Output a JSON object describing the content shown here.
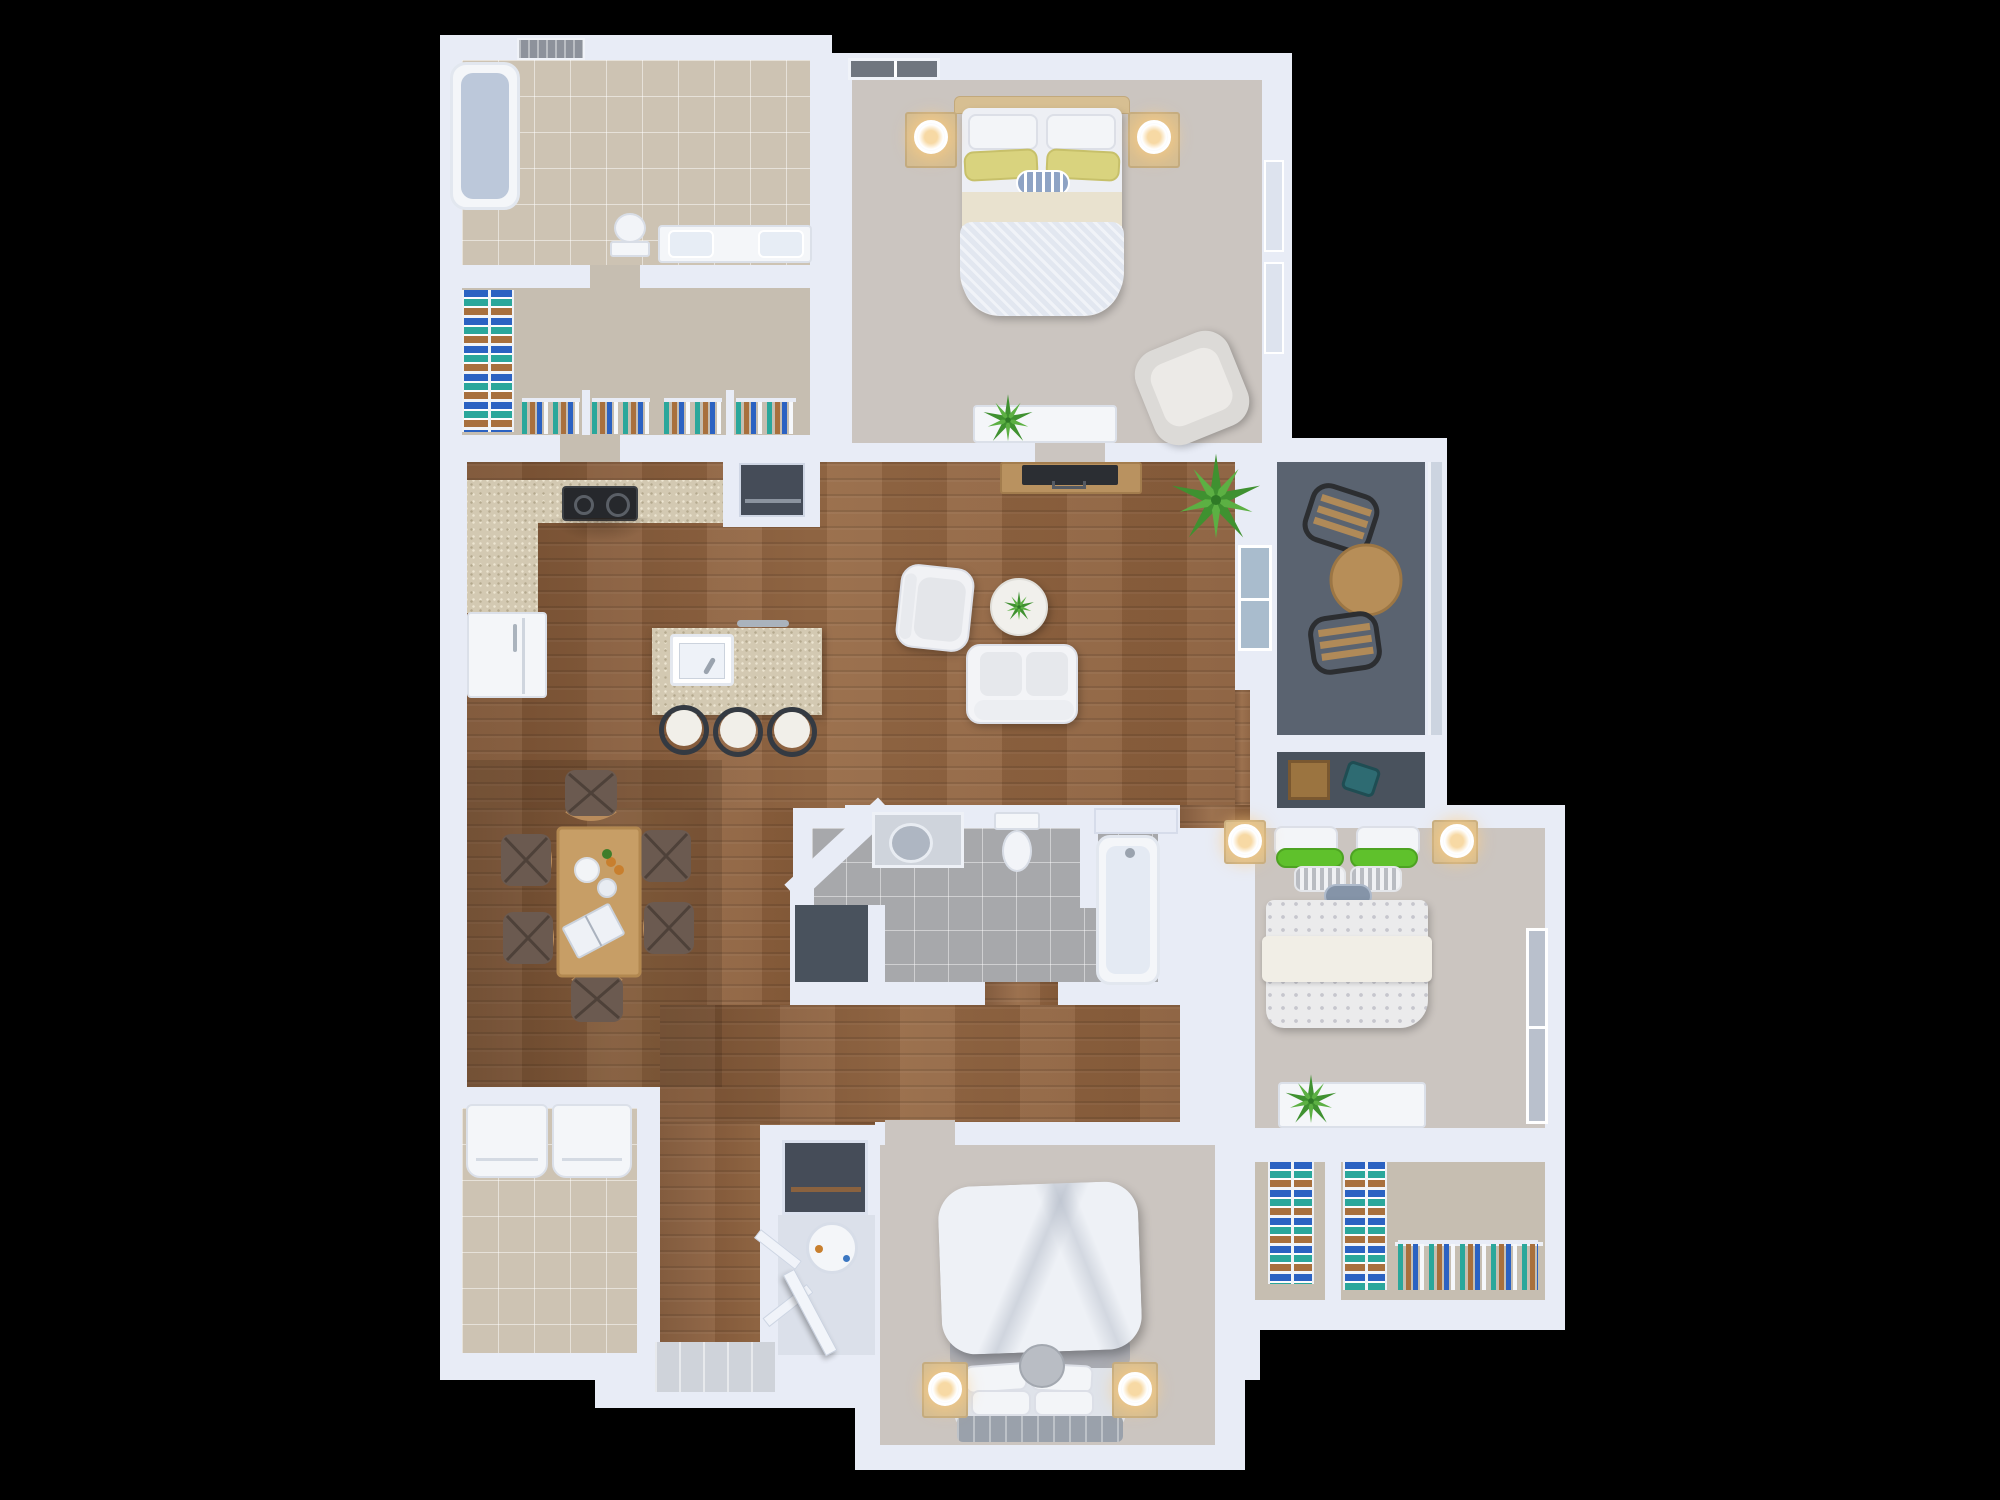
{
  "meta": {
    "title": "3D top-down apartment floor plan rendering",
    "canvas": {
      "width": 2000,
      "height": 1500
    },
    "style": "photoreal dollhouse floor plan on black background",
    "visible_text": []
  },
  "colors": {
    "bg": "#000000",
    "wall": "#e8ecf6",
    "wallEdge": "#ccd4e4",
    "wood": "#8a5e3b",
    "woodHi": "#976a46",
    "woodLo": "#7c5334",
    "carpet": "#cbc5c0",
    "carpetWarm": "#c6beb1",
    "tileBeige": "#cdc3b3",
    "tileGray": "#a7a8ab",
    "slate": "#5a6370",
    "slateDark": "#49525d",
    "granite": "#d3c9b2",
    "white": "#f4f6f9",
    "cream": "#e9e2cf",
    "headboardTan": "#d7bf92",
    "tan": "#d4bd93",
    "yellow": "#d9d37e",
    "green": "#5fc12c",
    "stripeGray": "#b9bcc2",
    "accentBlue": "#8ea3c4",
    "duvet": "#e2e7f0",
    "marble": "#f1f0ec",
    "glass": "#a9bccd",
    "lampGlow": "#f7d9a4",
    "plantA": "#3f9130",
    "plantB": "#5cb043",
    "tableWood": "#c79e66",
    "seatDark": "#6b5a50",
    "frameDark": "#2e3135",
    "tvDark": "#2b2e33",
    "teal": "#2aa79b",
    "blue": "#2b62c2",
    "brown": "#a8703d",
    "steel": "#aab3bd",
    "crate": "#9b7440",
    "tealObj": "#2e6b72",
    "tubInner": "#bcc8da",
    "tubInnerC": "#e4eaf3",
    "nicheDark": "#454c58",
    "heaterFloor": "#dbe0ea",
    "landing": "#cfd3da"
  },
  "rooms": [
    {
      "id": "master-bathroom",
      "name": "master bathroom",
      "floor": "beige tile"
    },
    {
      "id": "walk-in-closet",
      "name": "walk-in closet",
      "floor": "carpet"
    },
    {
      "id": "master-bedroom",
      "name": "master bedroom (top)",
      "floor": "carpet"
    },
    {
      "id": "balcony",
      "name": "balcony",
      "floor": "slate"
    },
    {
      "id": "balcony-storage",
      "name": "balcony storage closet",
      "floor": "slate"
    },
    {
      "id": "kitchen",
      "name": "kitchen",
      "floor": "hardwood"
    },
    {
      "id": "dining-area",
      "name": "dining area",
      "floor": "hardwood"
    },
    {
      "id": "living-room",
      "name": "living room",
      "floor": "hardwood"
    },
    {
      "id": "hallway",
      "name": "hallway / entry",
      "floor": "hardwood"
    },
    {
      "id": "second-bathroom",
      "name": "hall bathroom",
      "floor": "gray tile"
    },
    {
      "id": "second-bedroom",
      "name": "bedroom (right)",
      "floor": "carpet"
    },
    {
      "id": "bedroom-closets",
      "name": "bedroom closets (right)",
      "floor": "carpet"
    },
    {
      "id": "third-bedroom",
      "name": "bedroom (bottom)",
      "floor": "carpet"
    },
    {
      "id": "laundry-room",
      "name": "laundry room",
      "floor": "beige tile"
    },
    {
      "id": "utility-closet",
      "name": "water-heater closet",
      "floor": "light"
    }
  ],
  "furniture": {
    "master-bathroom": [
      "bathtub",
      "toilet",
      "double-sink vanity",
      "ceiling vent"
    ],
    "walk-in-closet": [
      "folded-clothes shelf tower",
      "four hanging-clothes racks"
    ],
    "master-bedroom": [
      "double bed with yellow and striped pillows",
      "two nightstands with lit lamps",
      "armchair",
      "low dresser with plant",
      "window"
    ],
    "balcony": [
      "two slat chairs",
      "round wood table",
      "railing"
    ],
    "balcony-storage": [
      "wooden crate",
      "teal case"
    ],
    "kitchen": [
      "L-shaped granite counter",
      "black cooktop",
      "refrigerator",
      "pantry nook",
      "island with sink and dishwasher",
      "three barstools"
    ],
    "dining-area": [
      "wood dining table",
      "six chairs",
      "plates",
      "open book"
    ],
    "living-room": [
      "TV console with flat TV",
      "tall plant",
      "armchair",
      "round marble coffee table with plant",
      "loveseat",
      "sliding glass door"
    ],
    "second-bathroom": [
      "vanity with round sink",
      "toilet",
      "bathtub",
      "linen niche",
      "dark closet"
    ],
    "second-bedroom": [
      "double bed with green pillows and patterned duvet",
      "two nightstands with lit lamps",
      "dresser with plant",
      "window"
    ],
    "bedroom-closets": [
      "two folded-clothes towers",
      "hanging-clothes rod"
    ],
    "third-bedroom": [
      "double bed with puffy duvet",
      "gray tufted headboard",
      "two nightstands with lit lamps"
    ],
    "laundry-room": [
      "washer",
      "dryer"
    ],
    "utility-closet": [
      "water heater",
      "two open louver doors",
      "dark storage niche"
    ],
    "entry": [
      "open front door",
      "plank landing"
    ]
  }
}
